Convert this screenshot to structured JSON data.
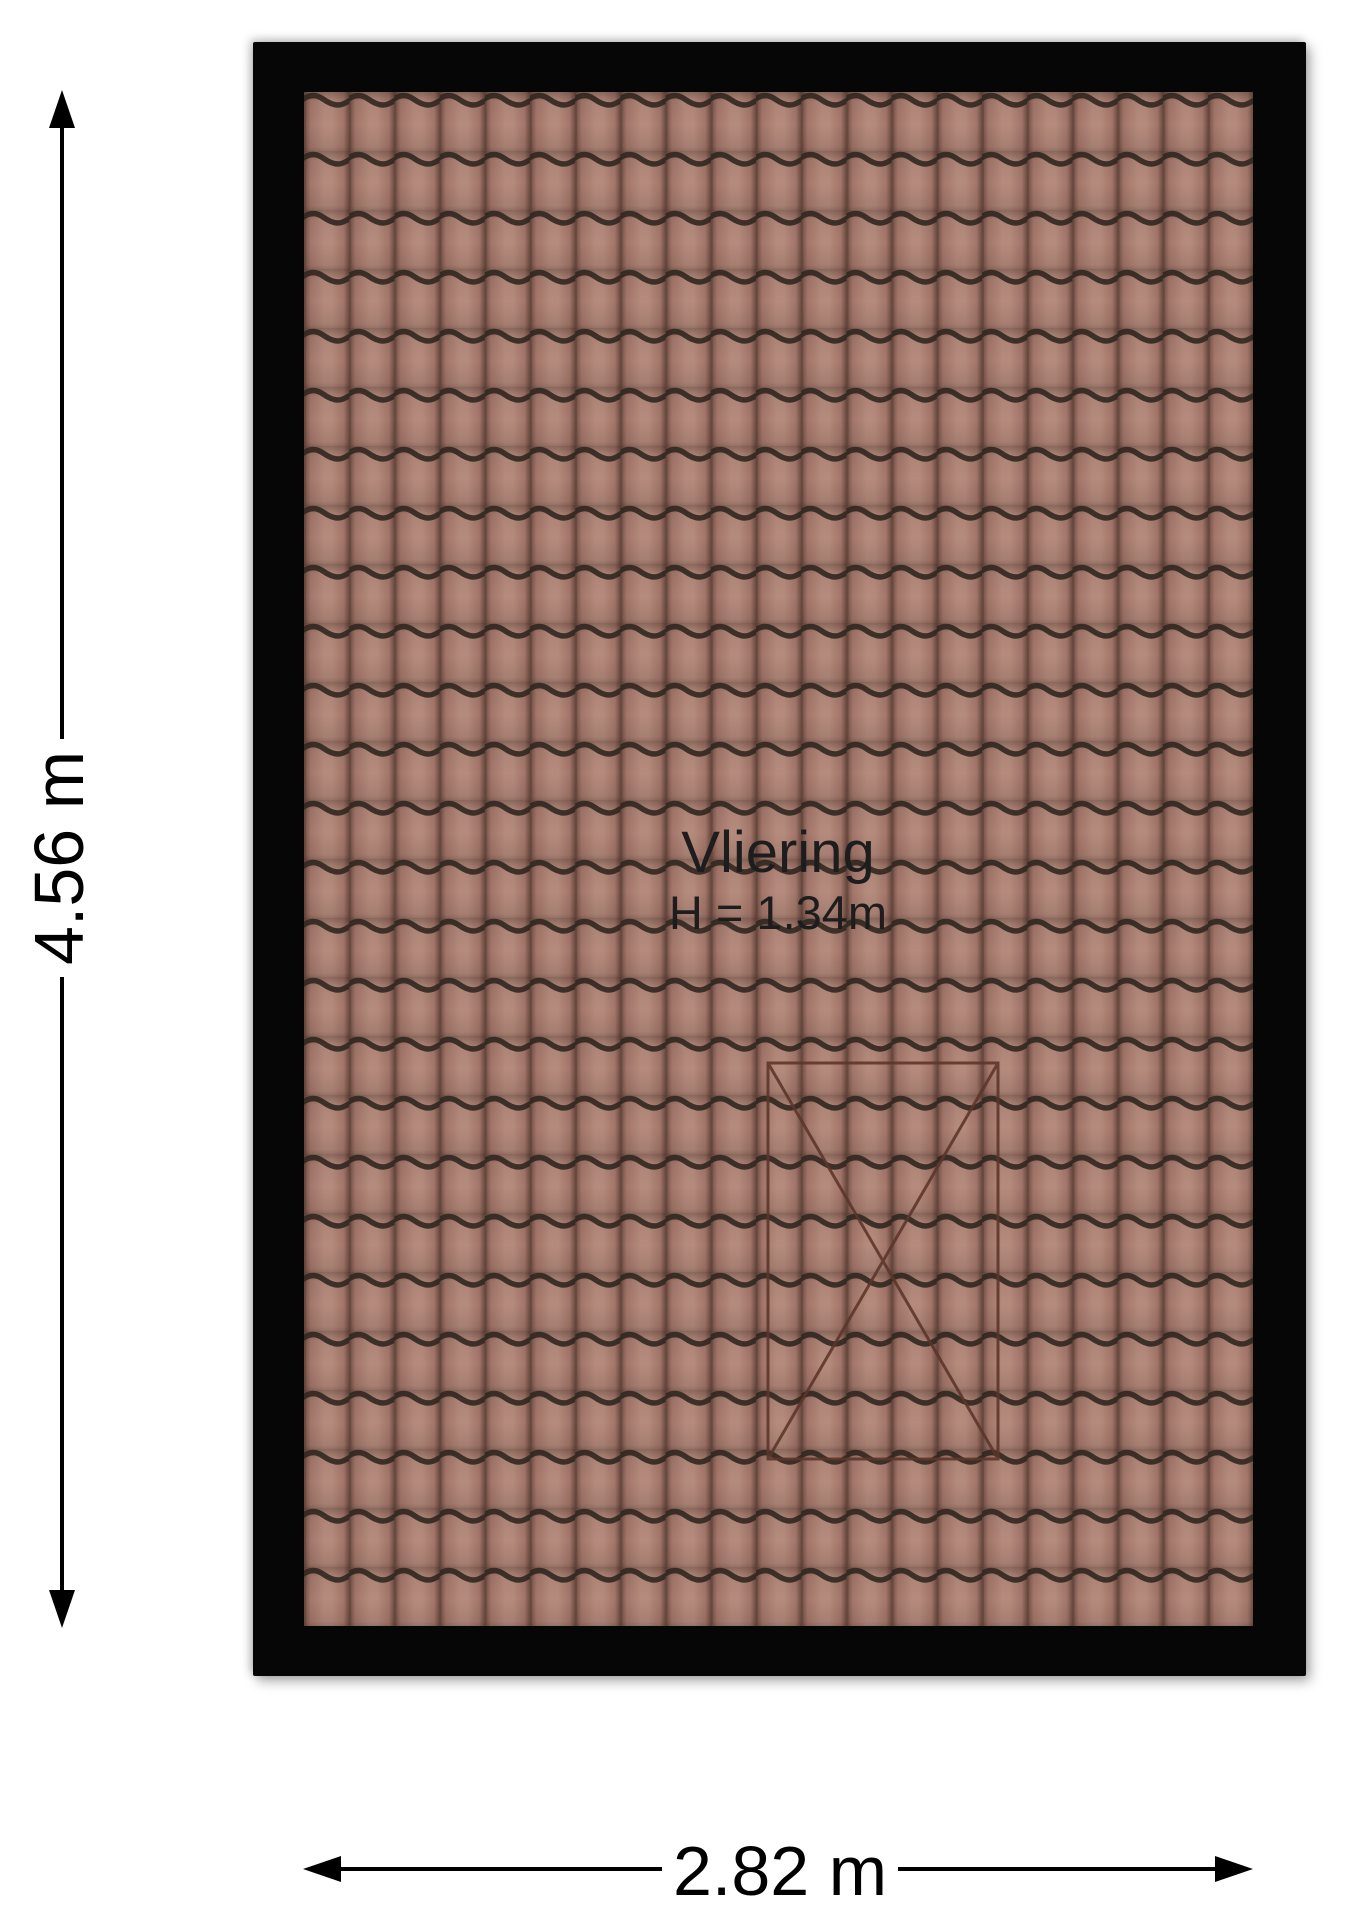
{
  "floorplan": {
    "room": {
      "name": "Vliering",
      "height_label": "H = 1.34m"
    },
    "dimensions": {
      "vertical": {
        "label": "4.56 m"
      },
      "horizontal": {
        "label": "2.82 m"
      }
    },
    "colors": {
      "background": "#ffffff",
      "plan_border": "#060606",
      "tile_light": "#b58b7d",
      "tile_mid": "#a3766a",
      "tile_edge": "#6d4c42",
      "tile_wave": "#30271f",
      "tile_seam": "#5e423a",
      "roof_window_cross": "#5c352a",
      "dimension_lines": "#000000",
      "room_text": "#1d1d1d"
    },
    "icons": {
      "arrow_up": "arrow-up-icon",
      "arrow_down": "arrow-down-icon",
      "arrow_left": "arrow-left-icon",
      "arrow_right": "arrow-right-icon"
    }
  }
}
